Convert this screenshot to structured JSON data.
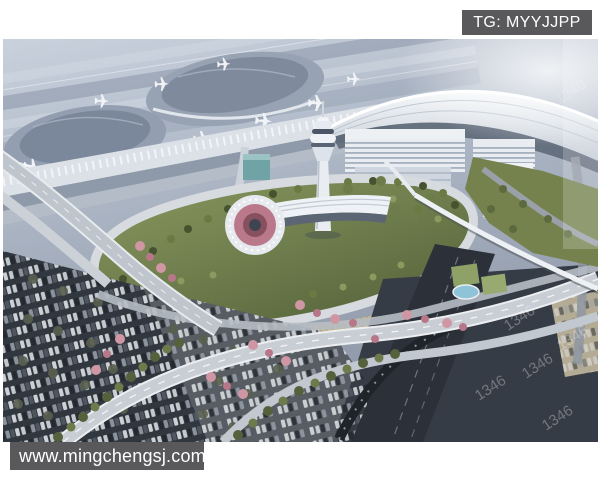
{
  "badges": {
    "telegram": {
      "text": "TG: MYYJJPP"
    },
    "website": {
      "text": "www.mingchengsj.com"
    },
    "style": {
      "background": "#59595b",
      "text_color": "#ffffff"
    }
  },
  "photo": {
    "kind": "aerial architectural rendering",
    "description": "Bird's-eye 3D rendering of an airport landside complex: terminal concourses and aircraft aprons at top left, a sweeping white arched canopy with office buildings at top right, a white control tower above a leaf-shaped landscaped ring road with a circular plaza, elevated ramps lined with pink blossom trees, and large car parks full of vehicles in the foreground",
    "watermark_text": "1346",
    "colors": {
      "apron_blue_gray": "#a9b3c2",
      "canopy_white": "#f2f4f8",
      "greenery": "#6b7a4a",
      "blossom_pink": "#cf97a4",
      "parking_dark": "#353b44",
      "road_light": "#c9ced5",
      "pond_blue": "#8fc3d8"
    }
  }
}
